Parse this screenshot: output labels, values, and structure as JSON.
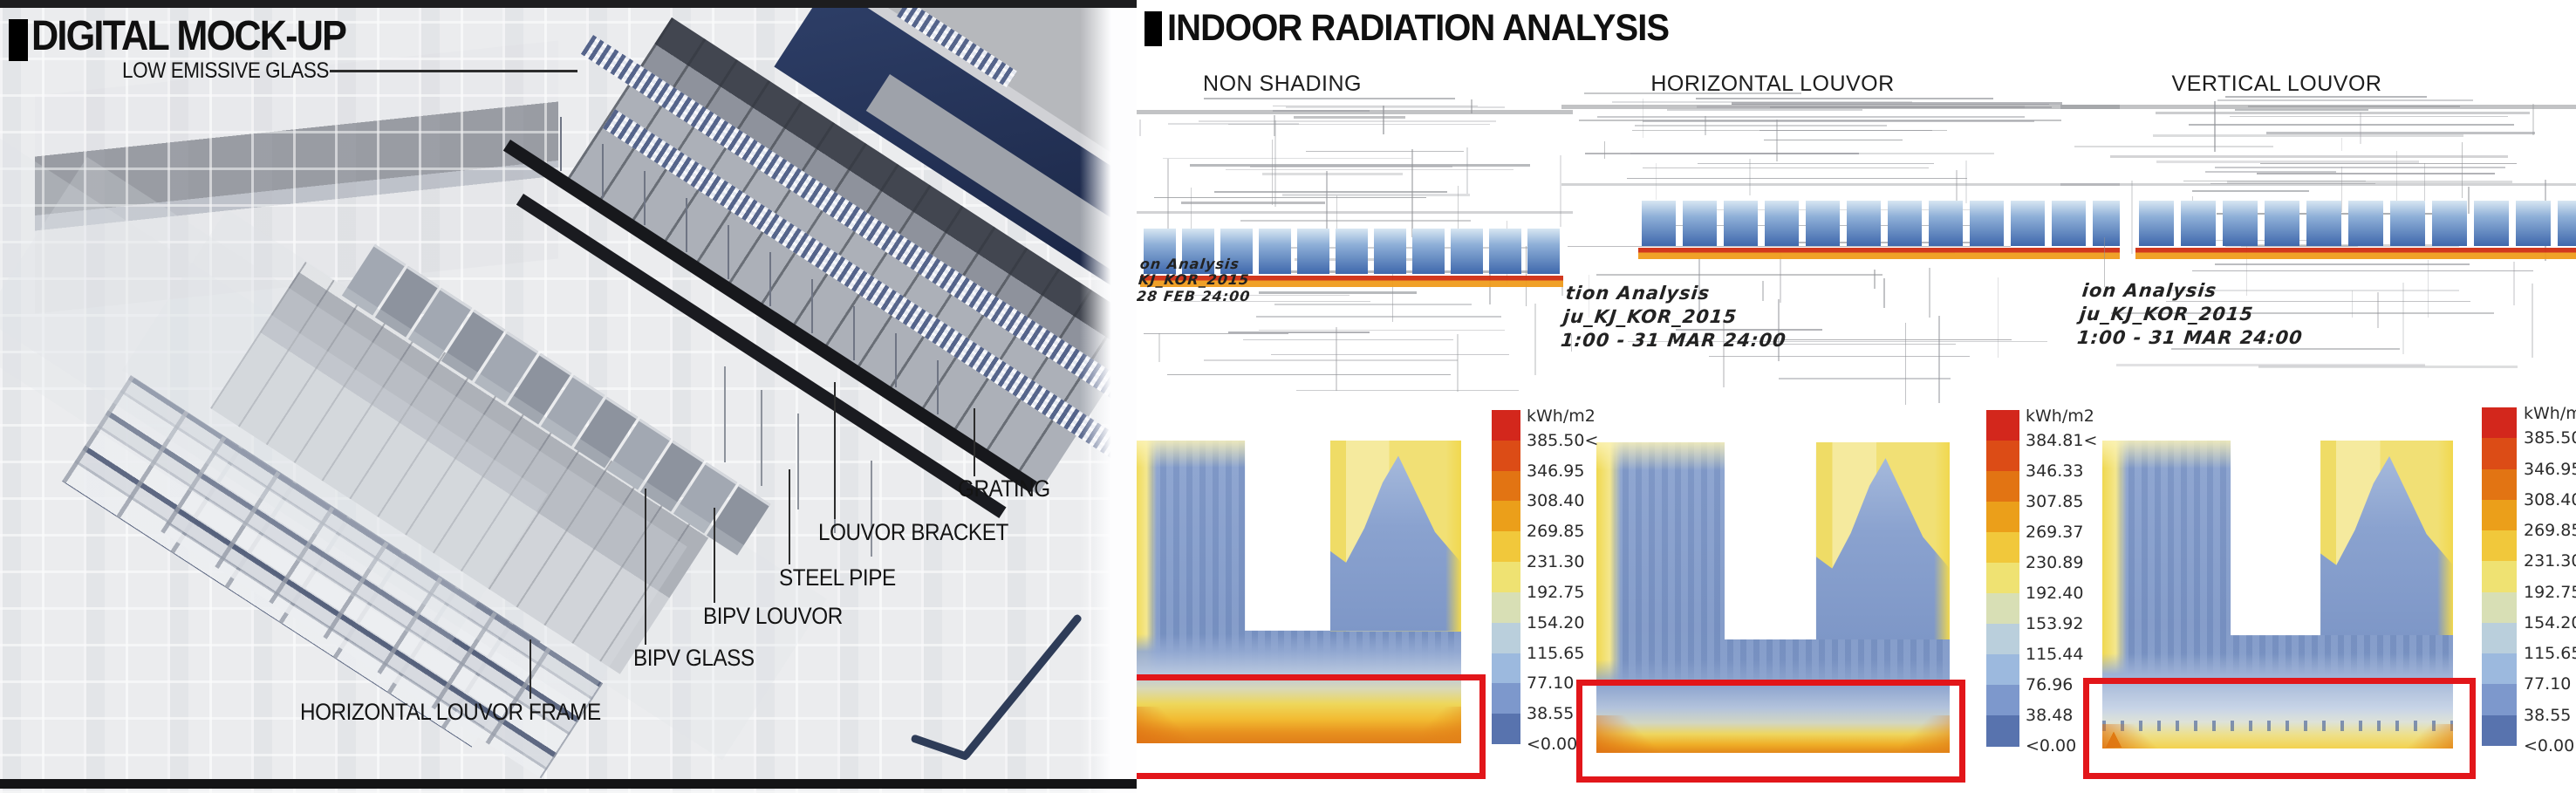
{
  "left_panel": {
    "title": "DIGITAL MOCK-UP",
    "callouts": [
      {
        "id": "low_emissive_glass",
        "label": "LOW EMISSIVE GLASS"
      },
      {
        "id": "grating",
        "label": "GRATING"
      },
      {
        "id": "louvor_bracket",
        "label": "LOUVOR BRACKET"
      },
      {
        "id": "steel_pipe",
        "label": "STEEL PIPE"
      },
      {
        "id": "bipv_louvor",
        "label": "BIPV LOUVOR"
      },
      {
        "id": "bipv_glass",
        "label": "BIPV GLASS"
      },
      {
        "id": "horizontal_louvor_frame",
        "label": "HORIZONTAL LOUVOR FRAME"
      }
    ]
  },
  "right_panel": {
    "title": "INDOOR RADIATION ANALYSIS",
    "columns": [
      {
        "header": "NON SHADING",
        "annotation_lines": [
          "on Analysis",
          "KJ_KOR_2015",
          "28 FEB 24:00"
        ]
      },
      {
        "header": "HORIZONTAL LOUVOR",
        "annotation_lines": [
          "tion Analysis",
          "ju_KJ_KOR_2015",
          "1:00 - 31 MAR 24:00"
        ]
      },
      {
        "header": "VERTICAL LOUVOR",
        "annotation_lines": [
          "ion Analysis",
          "ju_KJ_KOR_2015",
          "1:00 - 31 MAR 24:00"
        ]
      }
    ]
  },
  "chart_data": [
    {
      "type": "heatmap",
      "title": "NON SHADING",
      "unit": "kWh/m2",
      "legend_labels": [
        "385.50<",
        "346.95",
        "308.40",
        "269.85",
        "231.30",
        "192.75",
        "154.20",
        "115.65",
        "77.10",
        "38.55",
        "<0.00"
      ],
      "legend_colors": [
        "#d3271c",
        "#dc4c16",
        "#e27413",
        "#eb9f1a",
        "#f1c83b",
        "#efe272",
        "#d8dfb5",
        "#bacfdc",
        "#9cb9de",
        "#7d98cc",
        "#5873ae"
      ],
      "description": "U-shaped floor plan radiation map; strong yellow-orange band across the lower window zone, highlighted with a red box"
    },
    {
      "type": "heatmap",
      "title": "HORIZONTAL LOUVOR",
      "unit": "kWh/m2",
      "legend_labels": [
        "384.81<",
        "346.33",
        "307.85",
        "269.37",
        "230.89",
        "192.40",
        "153.92",
        "115.44",
        "76.96",
        "38.48",
        "<0.00"
      ],
      "legend_colors": [
        "#d3271c",
        "#dc4c16",
        "#e27413",
        "#eb9f1a",
        "#f1c83b",
        "#efe272",
        "#d8dfb5",
        "#bacfdc",
        "#9cb9de",
        "#7d98cc",
        "#5873ae"
      ],
      "description": "U-shaped floor plan radiation map; thinner orange strip limited to the lowest edge, highlighted with a red box"
    },
    {
      "type": "heatmap",
      "title": "VERTICAL LOUVOR",
      "unit": "kWh/m2",
      "legend_labels": [
        "385.50<",
        "346.95",
        "308.40",
        "269.85",
        "231.30",
        "192.75",
        "154.20",
        "115.65",
        "77.10",
        "38.55",
        "<0.00"
      ],
      "legend_colors": [
        "#d3271c",
        "#dc4c16",
        "#e27413",
        "#eb9f1a",
        "#f1c83b",
        "#efe272",
        "#d8dfb5",
        "#bacfdc",
        "#9cb9de",
        "#7d98cc",
        "#5873ae"
      ],
      "description": "U-shaped floor plan radiation map; row of small orange hot spots (louver pattern) along the lowest edge, highlighted with a red box"
    }
  ]
}
